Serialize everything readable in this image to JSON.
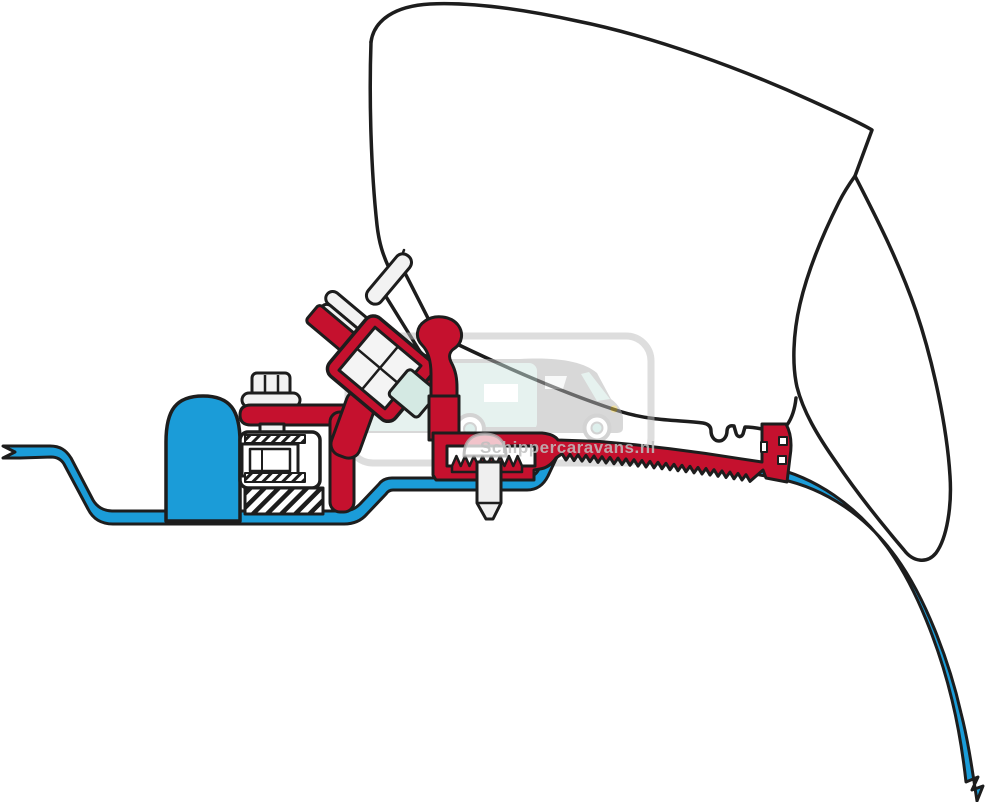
{
  "watermark": {
    "text": "Schippercaravans.nl"
  },
  "colors": {
    "bracket_red": "#c5112e",
    "roof_blue": "#1b9cd8",
    "outline_black": "#1d1d1d",
    "watermark_gray": "#bdbdbd",
    "window_teal": "#cfe7e1",
    "headlight_yellow": "#e3c44d"
  }
}
